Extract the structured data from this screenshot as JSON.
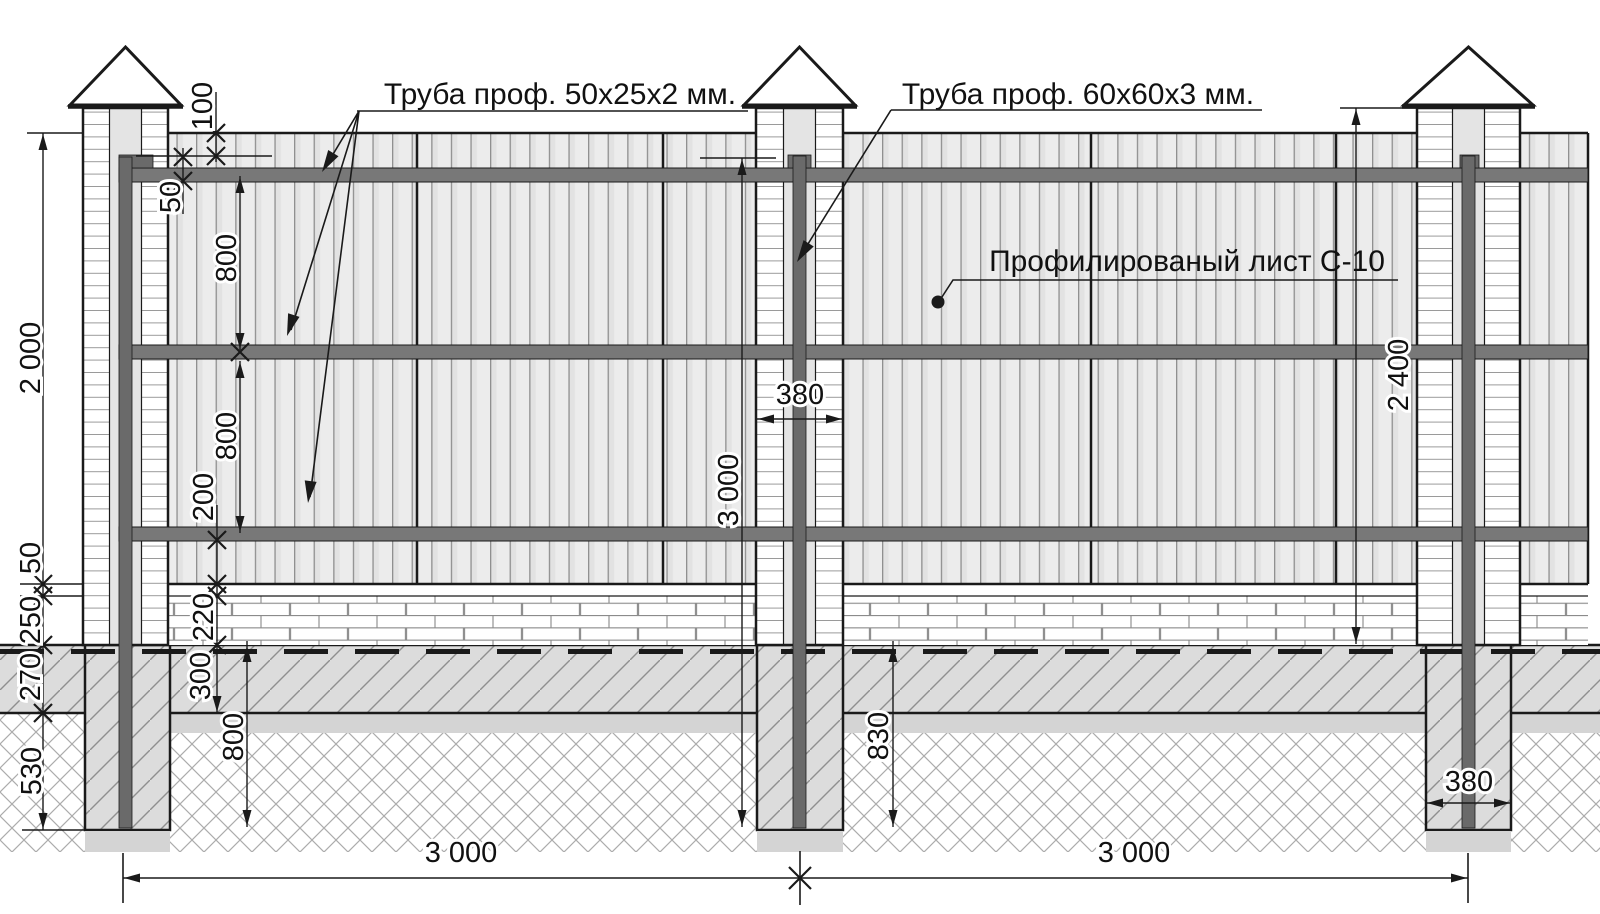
{
  "drawing": {
    "callouts": {
      "rail_tube": "Труба проф. 50х25х2 мм.",
      "post_tube": "Труба проф. 60х60х3 мм.",
      "sheet": "Профилированый лист С-10"
    },
    "dimensions": {
      "height_2000": "2 000",
      "gap_50": "50",
      "base_250": "250",
      "soil_270": "270",
      "depth_530": "530",
      "top_100": "100",
      "rail_50": "50",
      "bay_800_upper": "800",
      "bay_800_lower": "800",
      "bottom_200": "200",
      "plinth_220": "220",
      "embed_300": "300",
      "pier_depth_800": "800",
      "pier_depth_830": "830",
      "post_len_3000": "3 000",
      "pillar_h_2400": "2 400",
      "pillar_w_380": "380",
      "pier_w_380": "380",
      "span_left_3000": "3 000",
      "span_right_3000": "3 000"
    },
    "colors": {
      "steel_rail": "#787878",
      "steel_post": "#6a6a6a",
      "sheet_fill": "#ececec",
      "soil_fill": "#dcdcdc",
      "concrete_fill": "#d4d4d4",
      "line": "#1a1a1a"
    }
  }
}
